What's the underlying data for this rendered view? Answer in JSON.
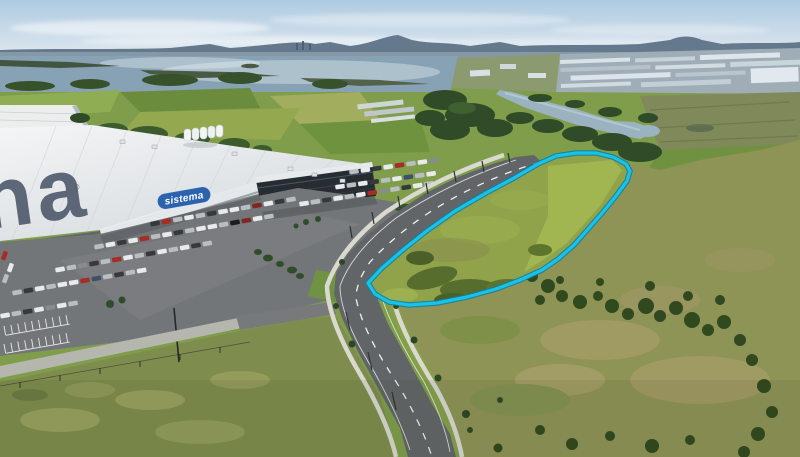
{
  "meta": {
    "type": "aerial-drone-photograph",
    "subject": "Vacant land parcel highlighted beside Sistema warehouse, carpark, boulevard and estuary farmland"
  },
  "labels": {
    "building_sign": "sistema",
    "roof_text": "na",
    "registered_mark": "®"
  },
  "colors": {
    "parcel_outline": "#19c3e8",
    "parcel_outline_edge": "#0e7fa2",
    "sign_blue": "#2b63ae",
    "roof_text_grey": "#515c6e",
    "water": "#87a2b4",
    "road": "#626568",
    "sky_top": "#b7cfe4",
    "grass": "#7f9d4a"
  }
}
